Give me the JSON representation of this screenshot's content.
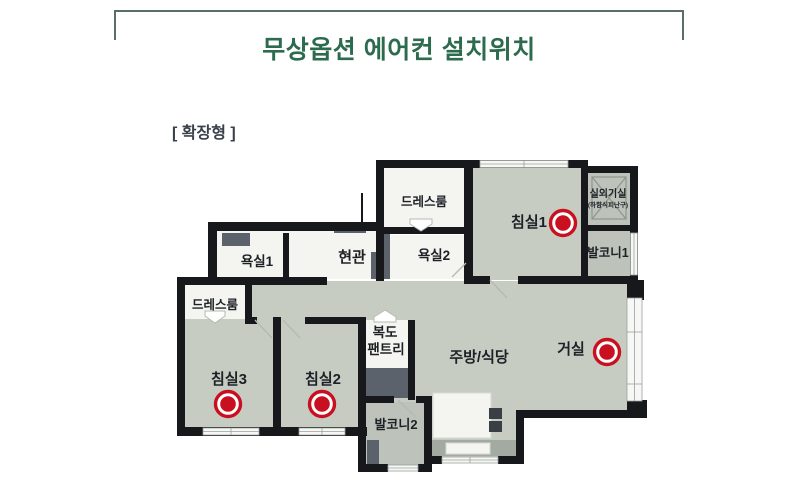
{
  "header": {
    "title": "무상옵션 에어컨 설치위치"
  },
  "plan_type": "[ 확장형 ]",
  "colors": {
    "title_green": "#2d6b4e",
    "subtitle_gray": "#3a414b",
    "bracket": "#5b6e63",
    "wall": "#17181b",
    "floor_main": "#c7ccc3",
    "floor_white": "#f4f4f0",
    "floor_balcony": "#bdc3ba",
    "accent_dark": "#5b626b",
    "counter": "#a2aaa1",
    "ac_red": "#c81021",
    "label_dark": "#1d2126"
  },
  "rooms": {
    "dressroom_top": "드레스룸",
    "bedroom1": "침실1",
    "outdoor_unit": "실외기실",
    "outdoor_unit_note": "(하향식피난구)",
    "balcony1": "발코니1",
    "bath1": "욕실1",
    "entrance": "현관",
    "bath2": "욕실2",
    "dressroom_left": "드레스룸",
    "corridor": "복도",
    "pantry": "팬트리",
    "kitchen": "주방/식당",
    "living": "거실",
    "bedroom3": "침실3",
    "bedroom2": "침실2",
    "balcony2": "발코니2"
  },
  "ac_markers": {
    "count": 4,
    "locations": [
      "침실1",
      "거실",
      "침실3",
      "침실2"
    ]
  }
}
